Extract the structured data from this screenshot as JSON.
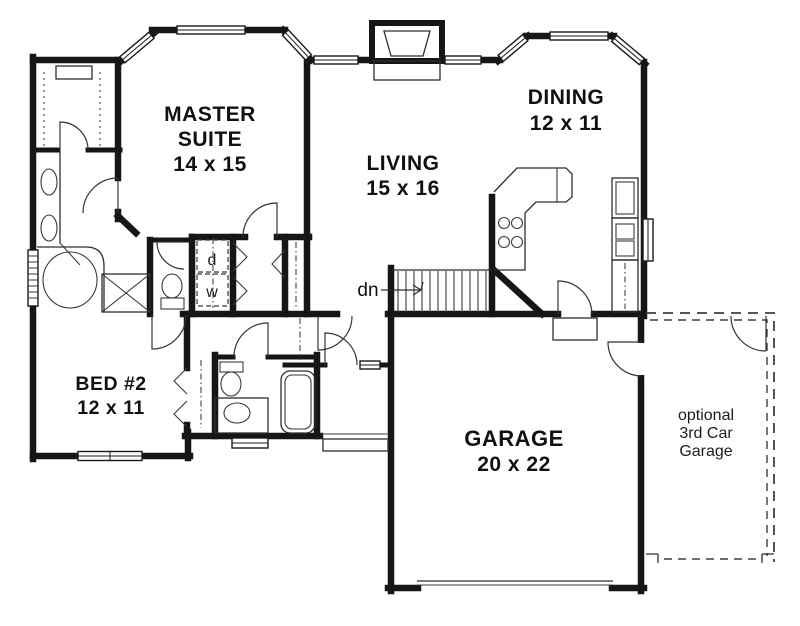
{
  "document": {
    "type": "floor-plan",
    "colors": {
      "wall": "#161616",
      "line": "#2e2e2e",
      "background": "#ffffff"
    }
  },
  "rooms": {
    "master_suite": {
      "line1": "MASTER",
      "line2": "SUITE",
      "dims": "14 x 15"
    },
    "living": {
      "name": "LIVING",
      "dims": "15 x 16"
    },
    "dining": {
      "name": "DINING",
      "dims": "12 x 11"
    },
    "bed2": {
      "name": "BED #2",
      "dims": "12 x 11"
    },
    "garage": {
      "name": "GARAGE",
      "dims": "20 x 22"
    },
    "optional_garage": {
      "line1": "optional",
      "line2": "3rd Car",
      "line3": "Garage"
    }
  },
  "annotations": {
    "stair_direction": "dn",
    "dryer": "d",
    "washer": "w"
  }
}
